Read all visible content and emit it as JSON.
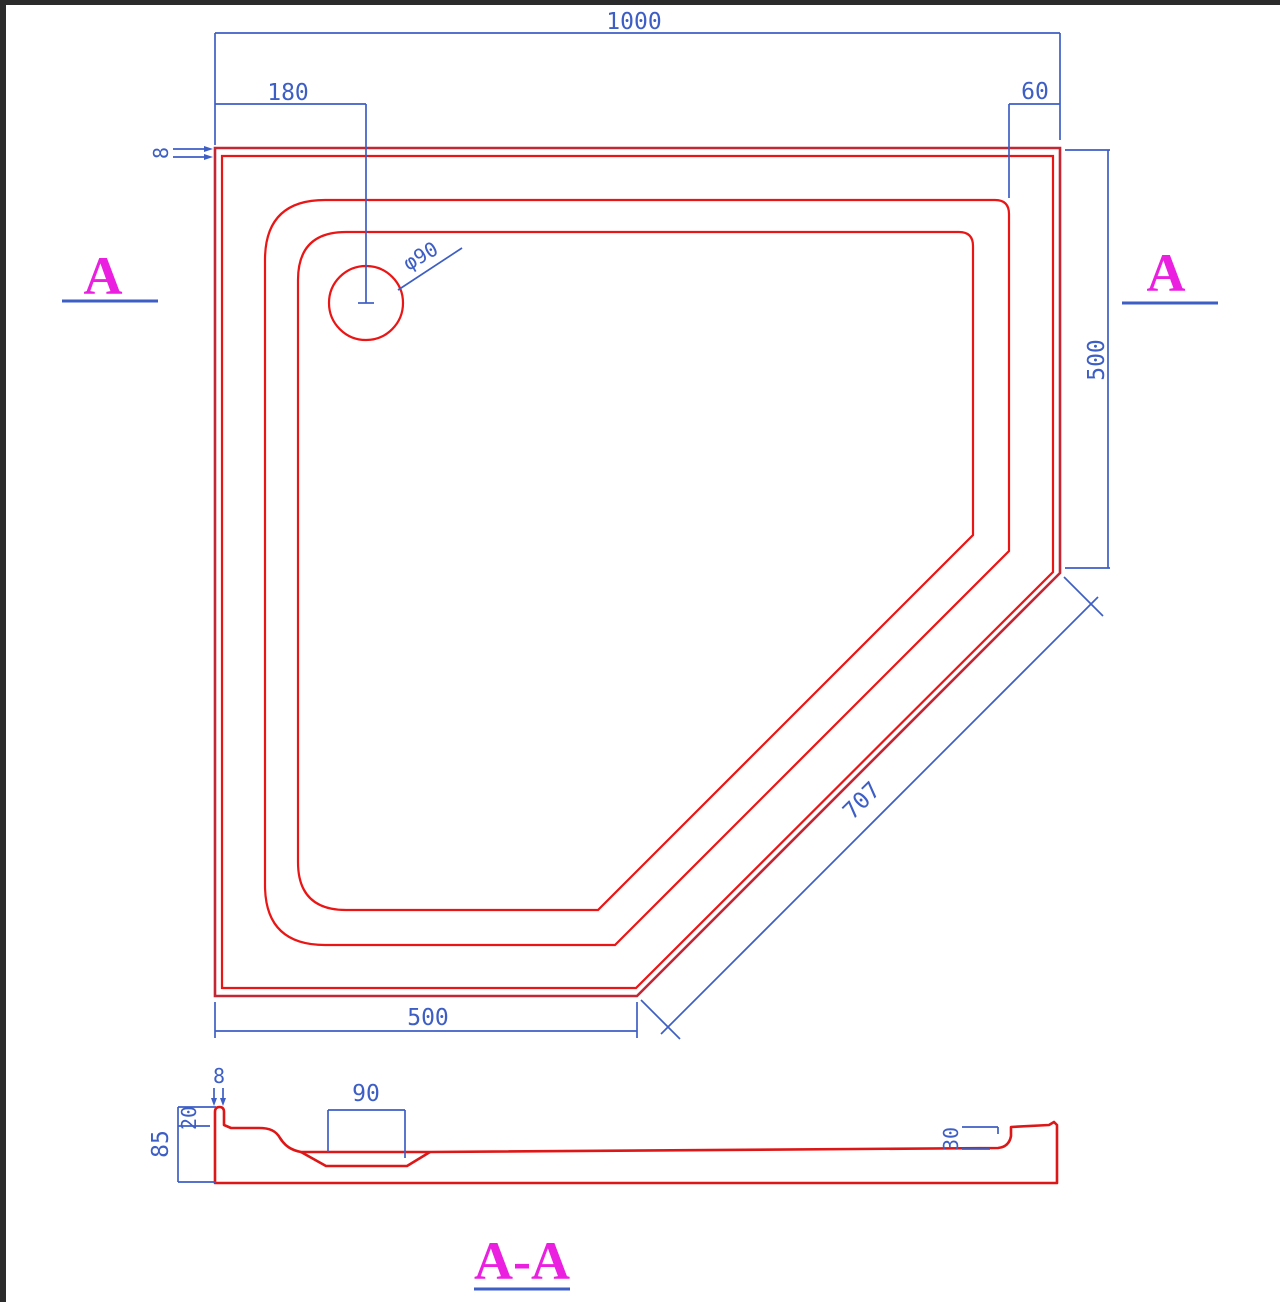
{
  "drawing": {
    "plan": {
      "dim_overall_width": "1000",
      "dim_drain_offset": "180",
      "dim_corner_inset": "60",
      "dim_rim_thickness": "8",
      "dim_right_side": "500",
      "dim_chamfer_length": "707",
      "dim_bottom_side": "500",
      "dim_drain_diameter": "φ90",
      "section_marker_left": "A",
      "section_marker_right": "A"
    },
    "section": {
      "title": "A-A",
      "dim_rim_width": "8",
      "dim_lip_depth": "20",
      "dim_total_height": "85",
      "dim_drain_width": "90",
      "dim_right_lip_height": "30"
    },
    "colors": {
      "outline_red": "#ea1515",
      "outline_dark_red": "#c22733",
      "dimension_blue": "#3d5ec4",
      "marker_magenta": "#ea1fe0",
      "frame_dark": "#2b2b2b",
      "background": "#ffffff"
    }
  }
}
